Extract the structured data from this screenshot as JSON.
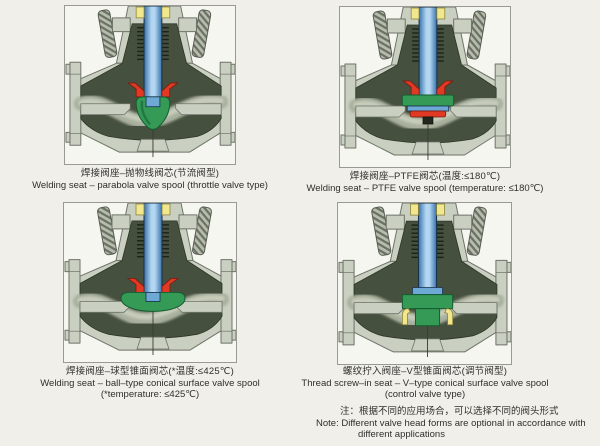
{
  "panels": [
    {
      "variant": "parabola",
      "caption_zh": "焊接阀座–抛物线阀芯(节流阀型)",
      "caption_en": "Welding seat – parabola valve spool (throttle valve type)",
      "caption_en2": ""
    },
    {
      "variant": "ptfe",
      "caption_zh": "焊接阀座–PTFE阀芯(温度:≤180℃)",
      "caption_en": "Welding seat – PTFE valve spool (temperature: ≤180℃)",
      "caption_en2": ""
    },
    {
      "variant": "ball",
      "caption_zh": "焊接阀座–球型锥面阀芯(*温度:≤425℃)",
      "caption_en": "Welding seat – ball–type conical surface valve spool",
      "caption_en2": "(*temperature: ≤425℃)"
    },
    {
      "variant": "vtype",
      "caption_zh": "螺纹拧入阀座–V型锥面阀芯(调节阀型)",
      "caption_en": "Thread screw–in seat – V–type conical surface valve spool",
      "caption_en2": "(control valve type)"
    }
  ],
  "note": {
    "zh": "注：根据不同的应用场合，可以选择不同的阀头形式",
    "en_line1": "Note: Different valve head forms are optional in accordance with",
    "en_line2": "different applications"
  },
  "colors": {
    "page_bg": "#f0efe9",
    "frame_bg": "#f6f6f1",
    "frame_border": "#9a9a94",
    "text": "#2f2f2d",
    "body_light": "#c9cfc1",
    "body_stroke": "#6d7468",
    "interior_dark": "#46503e",
    "interior_stroke": "#2e3527",
    "passage_sheen": "#a9b09e",
    "passage_core": "#c8cdbb",
    "stem_blue": "#3a72ab",
    "stem_blue_light": "#b3d7f2",
    "stem_outline": "#16304a",
    "stem_flange_blue": "#6ea9d6",
    "spool_green": "#349a55",
    "spool_green_dark": "#145c30",
    "seal_red": "#e03a24",
    "seal_red_dark": "#7e180c",
    "packing_yellow": "#f1e88d",
    "packing_outline": "#8d8440",
    "bolt_base": "#b6bcae",
    "bolt_hatch": "#6a7163",
    "thread_dark": "#1c2317",
    "nut_dark": "#23281f",
    "centerline": "#3a3a35"
  }
}
